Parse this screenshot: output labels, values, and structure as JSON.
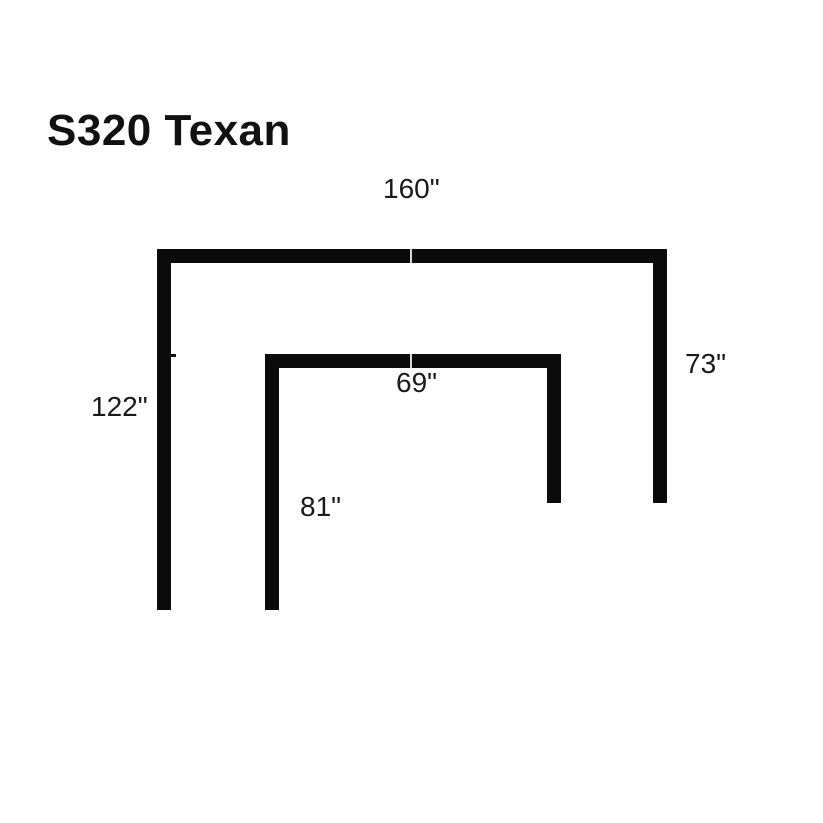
{
  "title": "S320 Texan",
  "diagram": {
    "description": "Top-view footprint dimension diagram of the S320 Texan sectional, drawn as two nested inverted-U outlines",
    "colors": {
      "background": "#ffffff",
      "bar": "#0b0b0b",
      "seam": "#d9d9d9",
      "text": "#1a1a1a"
    },
    "labels": {
      "outer_width": "160\"",
      "outer_left_depth": "122\"",
      "outer_right_depth": "73\"",
      "inner_width": "69\"",
      "inner_left_depth": "81\""
    }
  }
}
